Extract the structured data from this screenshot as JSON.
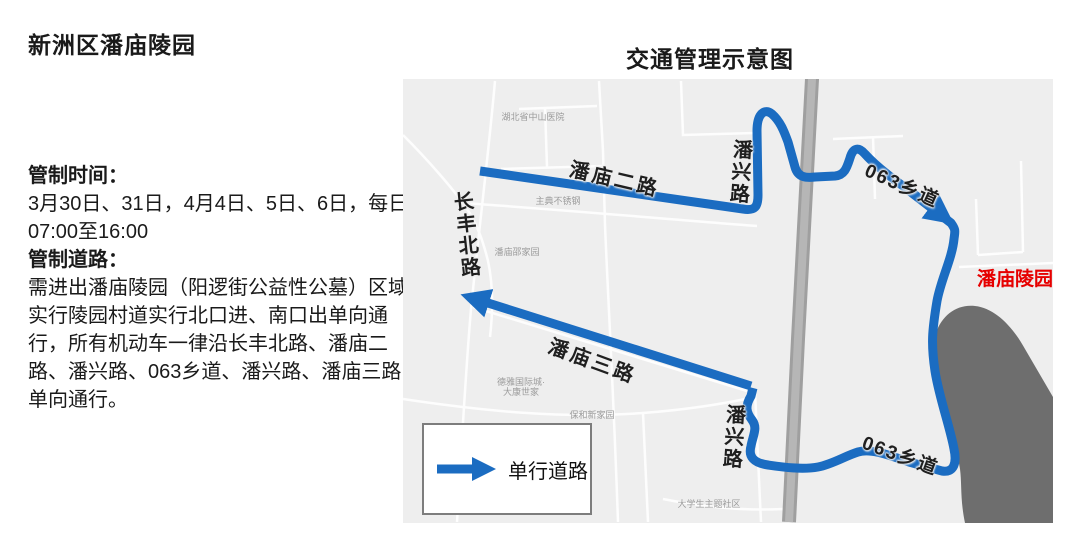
{
  "left_panel": {
    "title": "新洲区潘庙陵园",
    "control_time_heading": "管制时间：",
    "control_time_body": "3月30日、31日，4月4日、5日、6日，每日07:00至16:00",
    "control_road_heading": "管制道路：",
    "control_road_body": "需进出潘庙陵园（阳逻街公益性公墓）区域实行陵园村道实行北口进、南口出单向通行，所有机动车一律沿长丰北路、潘庙二路、潘兴路、063乡道、潘兴路、潘庙三路单向通行。"
  },
  "map": {
    "title": "交通管理示意图",
    "road_labels": {
      "panmiao_2": "潘庙二路",
      "panxing_north": "潘兴路",
      "xiang063_north": "063乡道",
      "changfeng_north": "长丰北路",
      "panmiao_3": "潘庙三路",
      "panxing_south": "潘兴路",
      "xiang063_south": "063乡道"
    },
    "poi_labels": {
      "hospital": "湖北省中山医院",
      "steel_shop": "主典不锈钢",
      "panmiao_shao": "潘庙邵家园",
      "deya_block": "德雅国际城·大康世家",
      "baohe_block": "保和新家园",
      "student_block": "大学生主题社区"
    },
    "destination": "潘庙陵园",
    "legend_label": "单行道路",
    "colors": {
      "route_blue": "#1b6cc1",
      "map_bg": "#eeeeee",
      "highway_gray": "#9f9f9f",
      "terrain_gray": "#6e6e6e",
      "destination_red": "#e60000"
    }
  }
}
